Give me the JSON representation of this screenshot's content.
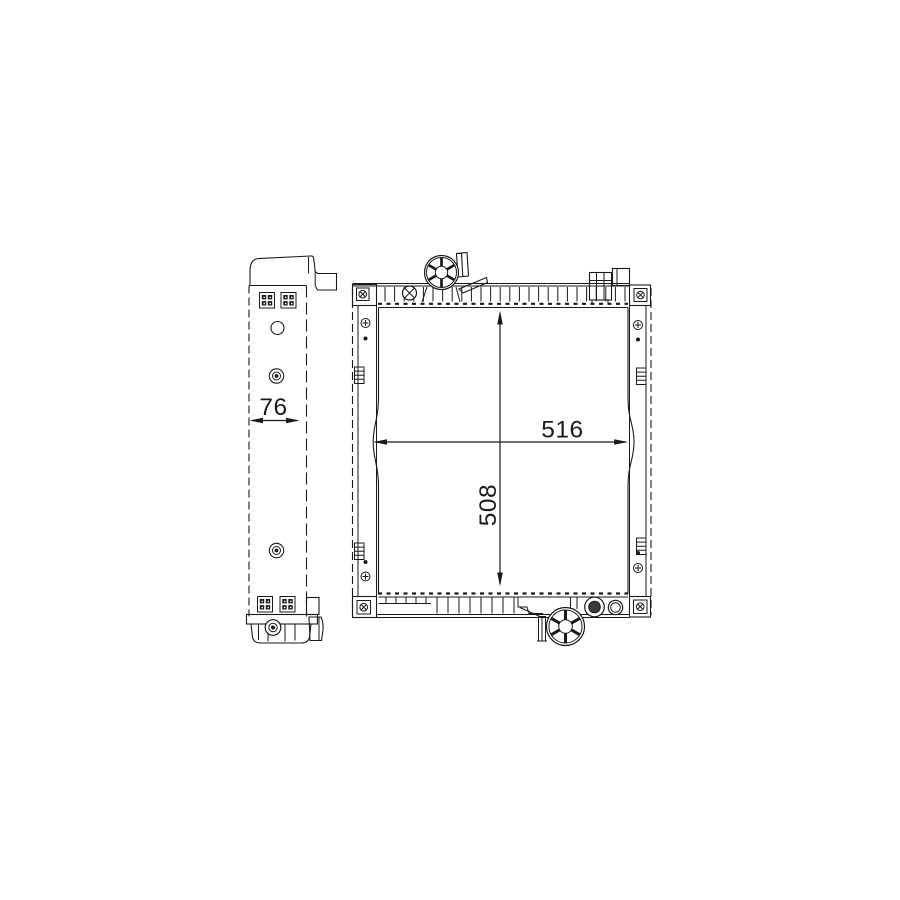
{
  "page": {
    "background": "#ffffff"
  },
  "drawing": {
    "type": "technical-line-drawing",
    "subject": "Radiator - two orthographic views (side profile and front face)",
    "line_color": "#1a1a1a",
    "views": [
      {
        "id": "side-view",
        "dimension_labels": [
          {
            "value": "76",
            "axis": "depth"
          }
        ]
      },
      {
        "id": "front-view",
        "dimension_labels": [
          {
            "value": "516",
            "axis": "width"
          },
          {
            "value": "508",
            "axis": "height"
          }
        ]
      }
    ],
    "labels": {
      "depth": "76",
      "width": "516",
      "height": "508"
    },
    "icons": {
      "filler-cap-icon": "circle-with-six-spokes",
      "outlet-pipe-icon": "circle-with-six-spokes",
      "bleed-screw-icon": "circle-with-x-cross",
      "bolt-icon": "concentric-circles-with-dot",
      "corner-bolt-icon": "square-with-x-bolt",
      "mounting-pad-icon": "square-with-four-studs",
      "clip-icon": "ribbed-rectangle"
    }
  }
}
